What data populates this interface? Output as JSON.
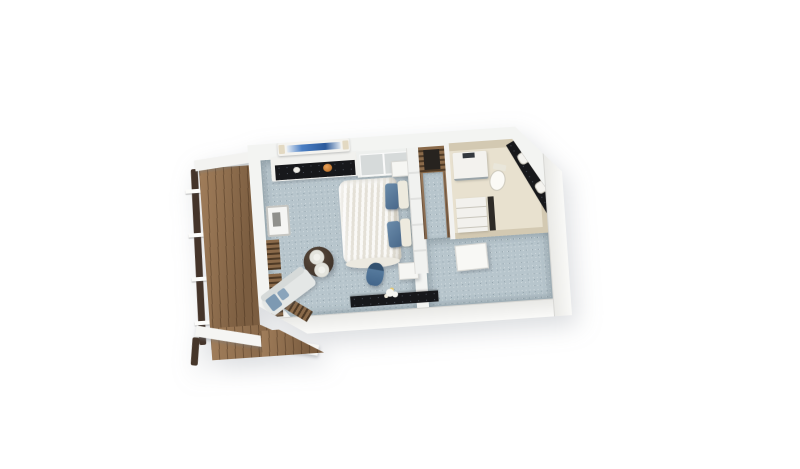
{
  "scene": {
    "type": "3d-isometric-floor-plan",
    "subject": "cruise-ship balcony stateroom cutaway render",
    "visible_text": "none",
    "background_color": "#ffffff",
    "rooms": [
      {
        "name": "balcony",
        "floor": "teak-wood-deck",
        "features": [
          "dark-wood-railing",
          "white-railing-posts",
          "white-privacy-divider",
          "deck-wraps-around-lower-corner"
        ]
      },
      {
        "name": "living-area",
        "floor": "blue-gray-carpet",
        "furniture": [
          "sofa-light-upholstery-blue-pillows",
          "round-dark-wood-table-two-white-place-settings",
          "tv-console-white-with-black-granite-top",
          "wall-mounted-tv-blue-screen",
          "fruit-bowl",
          "minibar-cabinet",
          "desk-black-granite-top",
          "blue-desk-chair",
          "white-flowers-on-desk",
          "floor-to-ceiling-window-wood-frames"
        ]
      },
      {
        "name": "bedroom",
        "floor": "blue-gray-carpet",
        "furniture": [
          "bed-white-fluffy-duvet",
          "two-blue-accent-pillows",
          "two-white-pillows",
          "white-headboard-partition-wall",
          "nightstand-upper",
          "nightstand-lower",
          "gray-window-panels-behind-bed"
        ]
      },
      {
        "name": "wardrobe-corridor",
        "floor": "wood-with-carpet-runner",
        "furniture": [
          "closet-wood-front-dark-interior"
        ]
      },
      {
        "name": "bathroom",
        "floor": "beige-tile",
        "walls": "beige",
        "shape": "angled-outer-wall",
        "furniture": [
          "shower-enclosure",
          "toilet",
          "black-granite-vanity-two-white-sinks",
          "storage-cabinet-with-shelves"
        ]
      },
      {
        "name": "entry",
        "floor": "blue-gray-carpet",
        "furniture": [
          "open-entry-door-white"
        ]
      }
    ],
    "palette": {
      "background": "#ffffff",
      "carpet": "#b7c5cc",
      "walls": "#f3f4f2",
      "wall_shadow": "#d8d8d5",
      "deck_wood": "#8a684a",
      "railing_dark": "#44342a",
      "window_frame_wood": "#6d5136",
      "granite_black": "#17181b",
      "bed_duvet": "#f0eee7",
      "pillow_blue": "#5b7fa0",
      "sofa_light": "#e4e7e6",
      "sofa_pillow_blue": "#7d99b2",
      "desk_chair_blue": "#4a6d90",
      "bathroom_wall_beige": "#d3c9b2",
      "bathroom_floor_beige": "#e8e1cf",
      "tv_screen_blue": "#3f74b5",
      "table_wood_dark": "#4a3c31",
      "corridor_wood": "#97785b"
    }
  }
}
